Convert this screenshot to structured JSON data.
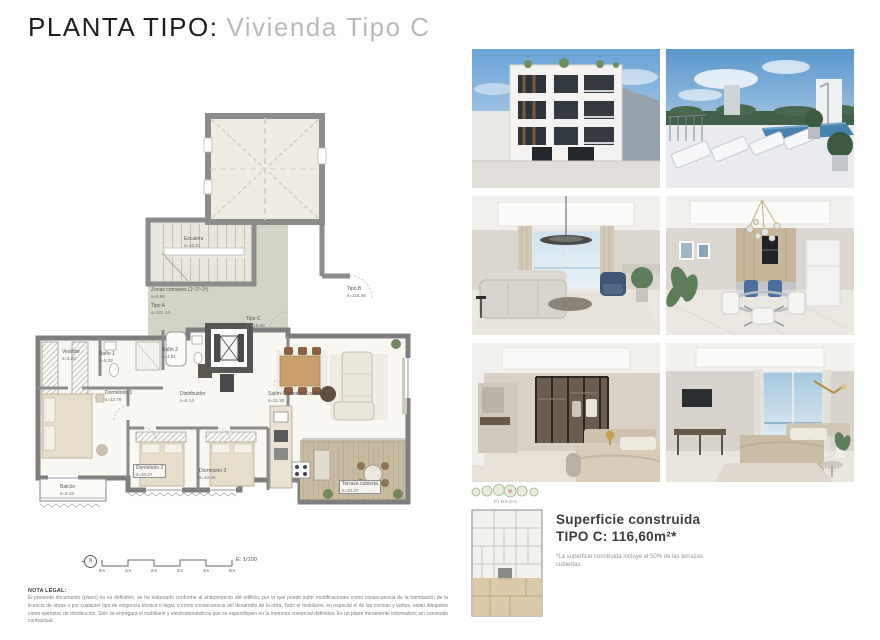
{
  "header": {
    "title": "PLANTA TIPO:",
    "subtitle": "Vivienda Tipo C"
  },
  "plan": {
    "zones": [
      {
        "label": "Escalera",
        "area": "s=10.21"
      },
      {
        "label": "Zonas comunes (1º-2º-3º)",
        "area": "s=6.96"
      },
      {
        "label": "Tipo A",
        "area": "s=121.14"
      },
      {
        "label": "Tipo B",
        "area": "s=116.48"
      },
      {
        "label": "Tipo C",
        "area": "s=116.60"
      }
    ],
    "rooms": [
      {
        "label": "Vestidor",
        "area": "s=4.20"
      },
      {
        "label": "Baño 1",
        "area": "s=5.32"
      },
      {
        "label": "Baño 2",
        "area": "s=4.81"
      },
      {
        "label": "Dormitorio 1",
        "area": "s=12.79"
      },
      {
        "label": "Distribuidor",
        "area": "s=8.14"
      },
      {
        "label": "Dormitorio 2",
        "area": "s=10.27"
      },
      {
        "label": "Dormitorio 3",
        "area": "s=10.44"
      },
      {
        "label": "Salón-Comedor-Cocina",
        "area": "s=31.90"
      },
      {
        "label": "Terraza cubierta",
        "area": "s=10.27"
      },
      {
        "label": "Balcón",
        "area": "s=2.18"
      }
    ],
    "scale": {
      "labels": [
        "0m",
        "1m",
        "2m",
        "3m",
        "4m",
        "5m"
      ],
      "ratio": "E: 1/100",
      "north": "N"
    }
  },
  "keyplan": {
    "title": "PINADA"
  },
  "summary": {
    "heading": "Superficie construida",
    "value": "TIPO C: 116,60m²*",
    "footnote": "*La superficie construida incluye el 50% de las terrazas cubiertas."
  },
  "legal": {
    "heading": "NOTA LEGAL:",
    "body": "El presente documento (plano) no es definitivo, se ha elaborado conforme al anteproyecto del edificio, por lo que puede sufrir modificaciones como consecuencia de la tramitación de la licencia de obras o por cualquier tipo de exigencia técnica o legal, o como consecuencia del desarrollo de la obra. Todo el mobiliario, en especial el de las cocinas y baños, están dibujados como ejemplos de distribución. Sólo se entregará el mobiliario y electrodomésticos que se especifiquen en la memoria comercial definitiva. Es un plano meramente informativo, sin contenido contractual."
  },
  "photos": [
    {
      "name": "facade-exterior"
    },
    {
      "name": "rooftop-solarium-pool"
    },
    {
      "name": "living-room"
    },
    {
      "name": "dining-kitchen"
    },
    {
      "name": "bedroom-dressing"
    },
    {
      "name": "bedroom-views"
    }
  ],
  "colors": {
    "accent_sage": "#d3d5c7",
    "wall_gray": "#7e7e7e",
    "wood": "#c9bba1",
    "highlight_tan": "#d8c49e"
  }
}
